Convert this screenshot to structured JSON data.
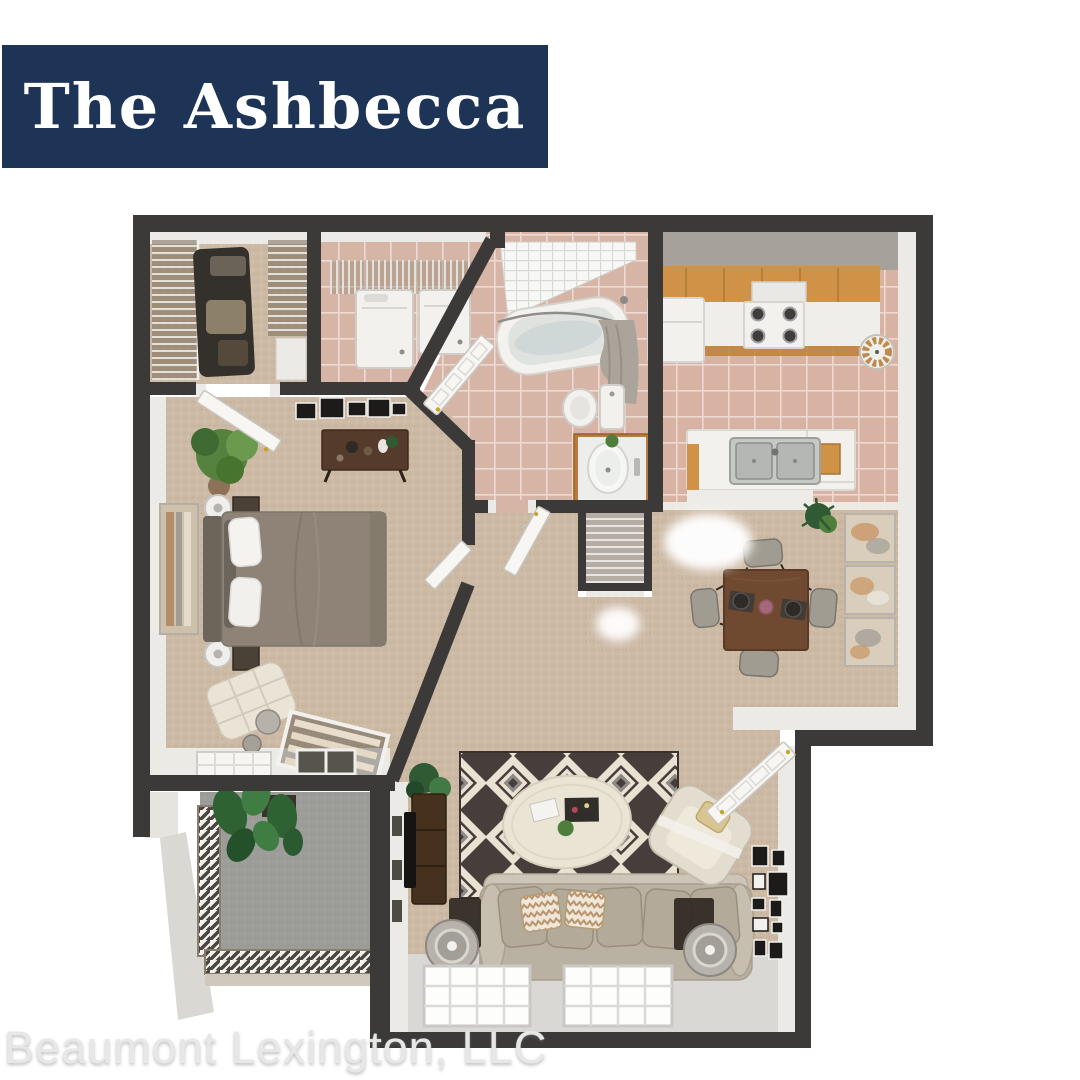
{
  "banner": {
    "title": "The Ashbecca"
  },
  "footer": {
    "text": "Beaumont Lexington, LLC"
  },
  "floorplan": {
    "description": "3D top-down rendered one-bedroom apartment floor plan",
    "rooms": [
      "walk-in-closet",
      "laundry",
      "bathroom",
      "kitchen",
      "dining-area",
      "bedroom",
      "hallway",
      "living-room",
      "patio"
    ]
  },
  "colors": {
    "page_bg": "#ffffff",
    "banner_bg": "#1e3456",
    "banner_text": "#ffffff",
    "watermark_text": "#e7e7e7",
    "wall": "#3b3a38",
    "wall_top": "#eceae6",
    "carpet": "#cdbaa5",
    "tile": "#d7b5a6",
    "kitchen_tile": "#d8b2a2",
    "patio_floor": "#9c9c98",
    "sill": "#d9d8d4",
    "wood_cabinet": "#cf9246",
    "wood_vanity": "#b97a3e",
    "table_wood": "#6f4a30",
    "sofa": "#b9b1a1",
    "sofa_back": "#cdc6b8",
    "bed": "#8e8376",
    "rug_dark": "#473e3b",
    "rug_cream": "#e9e1d2",
    "rug_gray": "#8d8a85",
    "plant": "#4e7d3c",
    "plant_dark": "#2f5a33",
    "chair_gray": "#a19c91",
    "appliance": "#f2f1ee",
    "gold": "#c9a227",
    "glass_dark": "#57544b"
  }
}
